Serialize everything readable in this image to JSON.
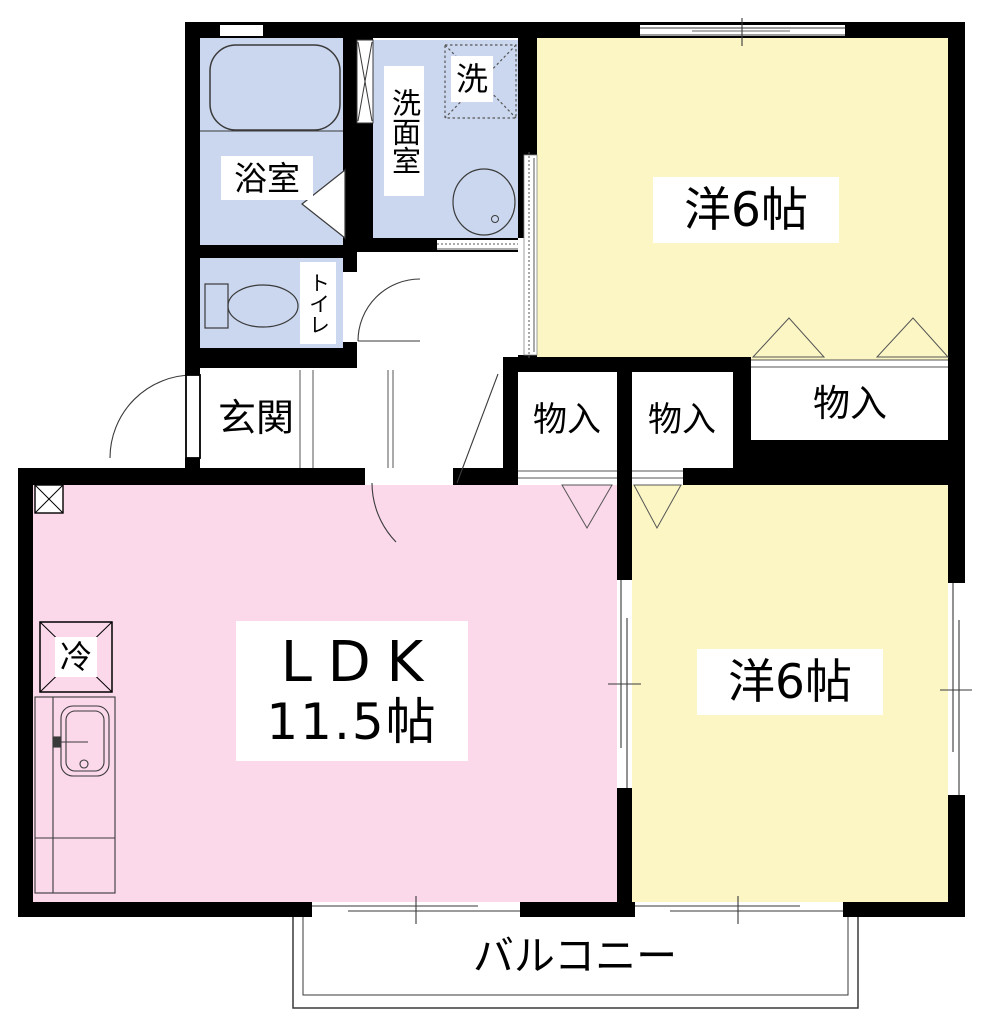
{
  "floorplan": {
    "title": "2LDK apartment floor plan",
    "rooms": {
      "bathroom": {
        "label": "浴室"
      },
      "washroom": {
        "label": "洗面室",
        "washer_label": "洗"
      },
      "toilet": {
        "label": "トイレ"
      },
      "entrance": {
        "label": "玄関"
      },
      "bedroom_top": {
        "label": "洋6帖"
      },
      "closet1": {
        "label": "物入"
      },
      "closet2": {
        "label": "物入"
      },
      "closet3": {
        "label": "物入"
      },
      "ldk": {
        "label_line1": "LDK",
        "label_line2": "11.5帖"
      },
      "bedroom_right": {
        "label": "洋6帖"
      },
      "refrigerator": {
        "label": "冷"
      },
      "balcony": {
        "label": "バルコニー"
      }
    },
    "colors": {
      "wet_area": "#CBD7EF",
      "bedroom": "#FBF6C4",
      "ldk": "#FBD8EA",
      "wall": "#000000",
      "line": "#3a3a3a",
      "thin": "#666666",
      "white": "#ffffff"
    }
  }
}
